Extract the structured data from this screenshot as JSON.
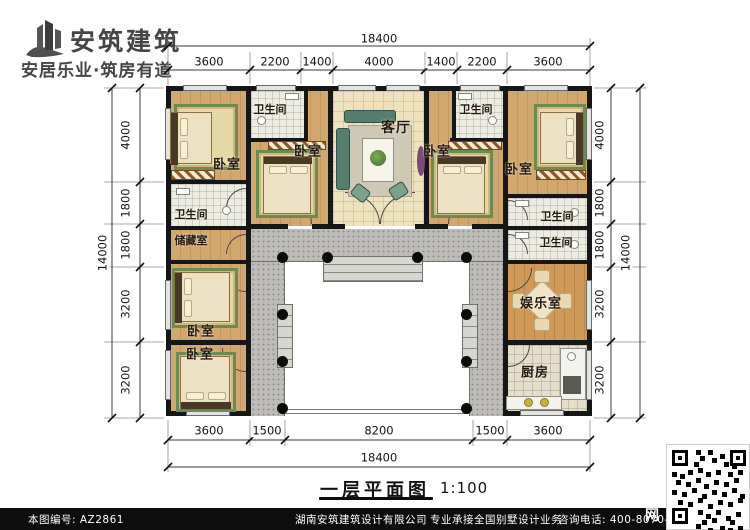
{
  "brand": {
    "name": "安筑建筑",
    "tagline": "安居乐业·筑房有道",
    "logo_color": "#4a4a4a"
  },
  "title": {
    "text": "一层平面图",
    "scale": "1:100"
  },
  "dimensions": {
    "top": {
      "total": "18400",
      "segments": [
        "3600",
        "2200",
        "1400",
        "4000",
        "1400",
        "2200",
        "3600"
      ]
    },
    "bottom": {
      "total": "18400",
      "segments": [
        "3600",
        "1500",
        "8200",
        "1500",
        "3600"
      ]
    },
    "left": {
      "total": "14000",
      "segments": [
        "4000",
        "1800",
        "1800",
        "3200",
        "3200"
      ]
    },
    "right": {
      "total": "14000",
      "segments": [
        "4000",
        "1800",
        "1800",
        "3200",
        "3200"
      ]
    }
  },
  "rooms": {
    "living": "客厅",
    "bedroom": "卧室",
    "bathroom": "卫生间",
    "storage": "储藏室",
    "entertainment": "娱乐室",
    "kitchen": "厨房"
  },
  "footer": {
    "plan_no": "本图编号: AZ2861",
    "company": "湖南安筑建筑设计有限公司",
    "service": "专业承接全国别墅设计业务",
    "phone": "咨询电话: 400-8070-511",
    "qr_side_char": "网"
  },
  "watermark": "安筑建筑",
  "colors": {
    "wall": "#161616",
    "wood_floor": "#d2a76e",
    "warm_tile": "#eee1bd",
    "porch_gray": "#bdbcb8",
    "rug_green": "#6d8a54",
    "brand_gray": "#4a4a4a",
    "footer_bg": "#0d0d0d"
  }
}
